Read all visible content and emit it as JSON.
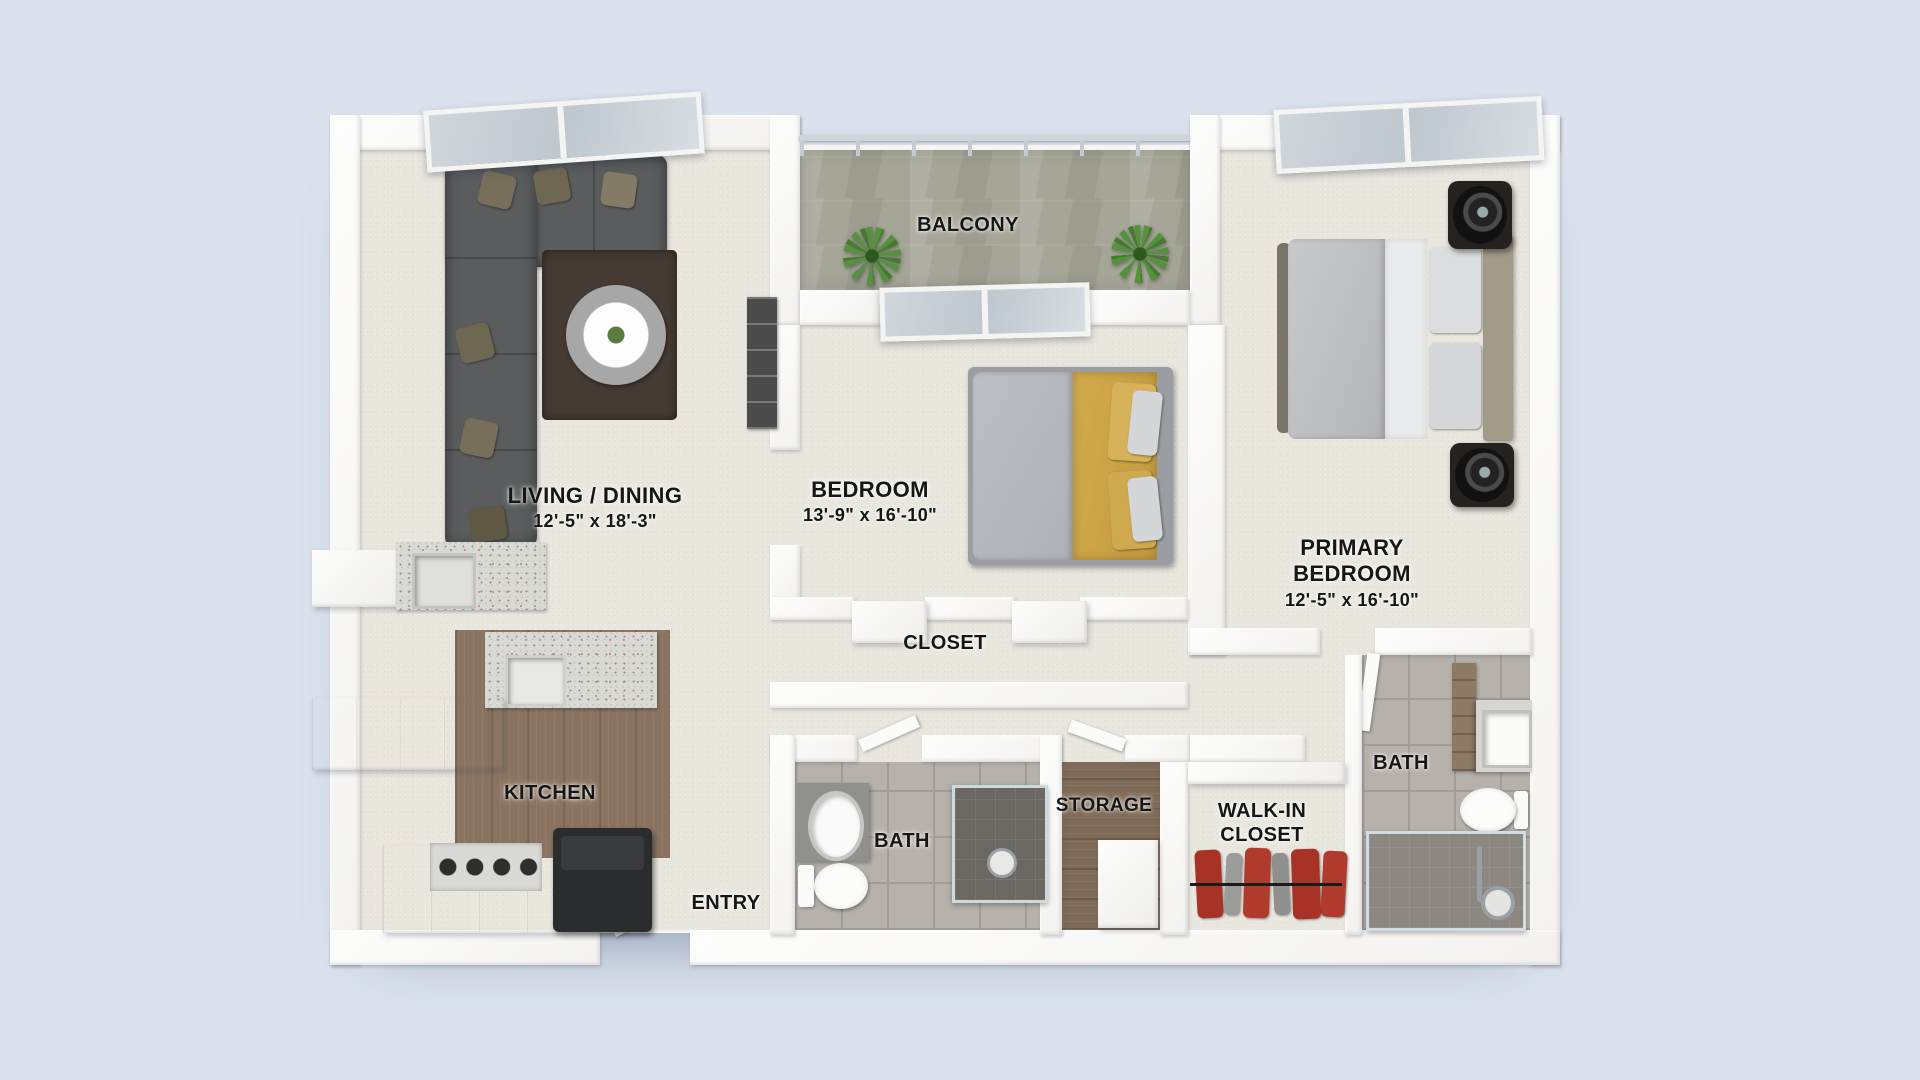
{
  "floor_plan": {
    "rooms": [
      {
        "id": "living_dining",
        "name": "LIVING / DINING",
        "dimensions": "12'-5\" x 18'-3\""
      },
      {
        "id": "balcony",
        "name": "BALCONY"
      },
      {
        "id": "bedroom",
        "name": "BEDROOM",
        "dimensions": "13'-9\" x 16'-10\""
      },
      {
        "id": "primary_bedroom",
        "name": "PRIMARY BEDROOM",
        "dimensions": "12'-5\" x 16'-10\""
      },
      {
        "id": "closet",
        "name": "CLOSET"
      },
      {
        "id": "kitchen",
        "name": "KITCHEN"
      },
      {
        "id": "entry",
        "name": "ENTRY"
      },
      {
        "id": "bath_main",
        "name": "BATH"
      },
      {
        "id": "storage",
        "name": "STORAGE"
      },
      {
        "id": "walk_in_closet",
        "name": "WALK-IN CLOSET"
      },
      {
        "id": "bath_primary",
        "name": "BATH"
      }
    ],
    "colors": {
      "background": "#dbe2ee",
      "wall": "#f7f6f3",
      "carpet": "#e9e6de",
      "balcony_floor": "#a6a698",
      "kitchen_floor": "#8a7461",
      "storage_floor": "#7e6a56",
      "bathroom_tile": "#b6b1ab",
      "shower_tile": "#6b6763",
      "sofa": "#5a5c5d",
      "dining_rug": "#463b33",
      "bed_blanket_yellow": "#cda645",
      "bedding_gray": "#c3c4c6",
      "clothes_red": "#a93226",
      "plant_green": "#55923d",
      "window_glass": "#c9d1d9",
      "label_text": "#161616"
    }
  }
}
